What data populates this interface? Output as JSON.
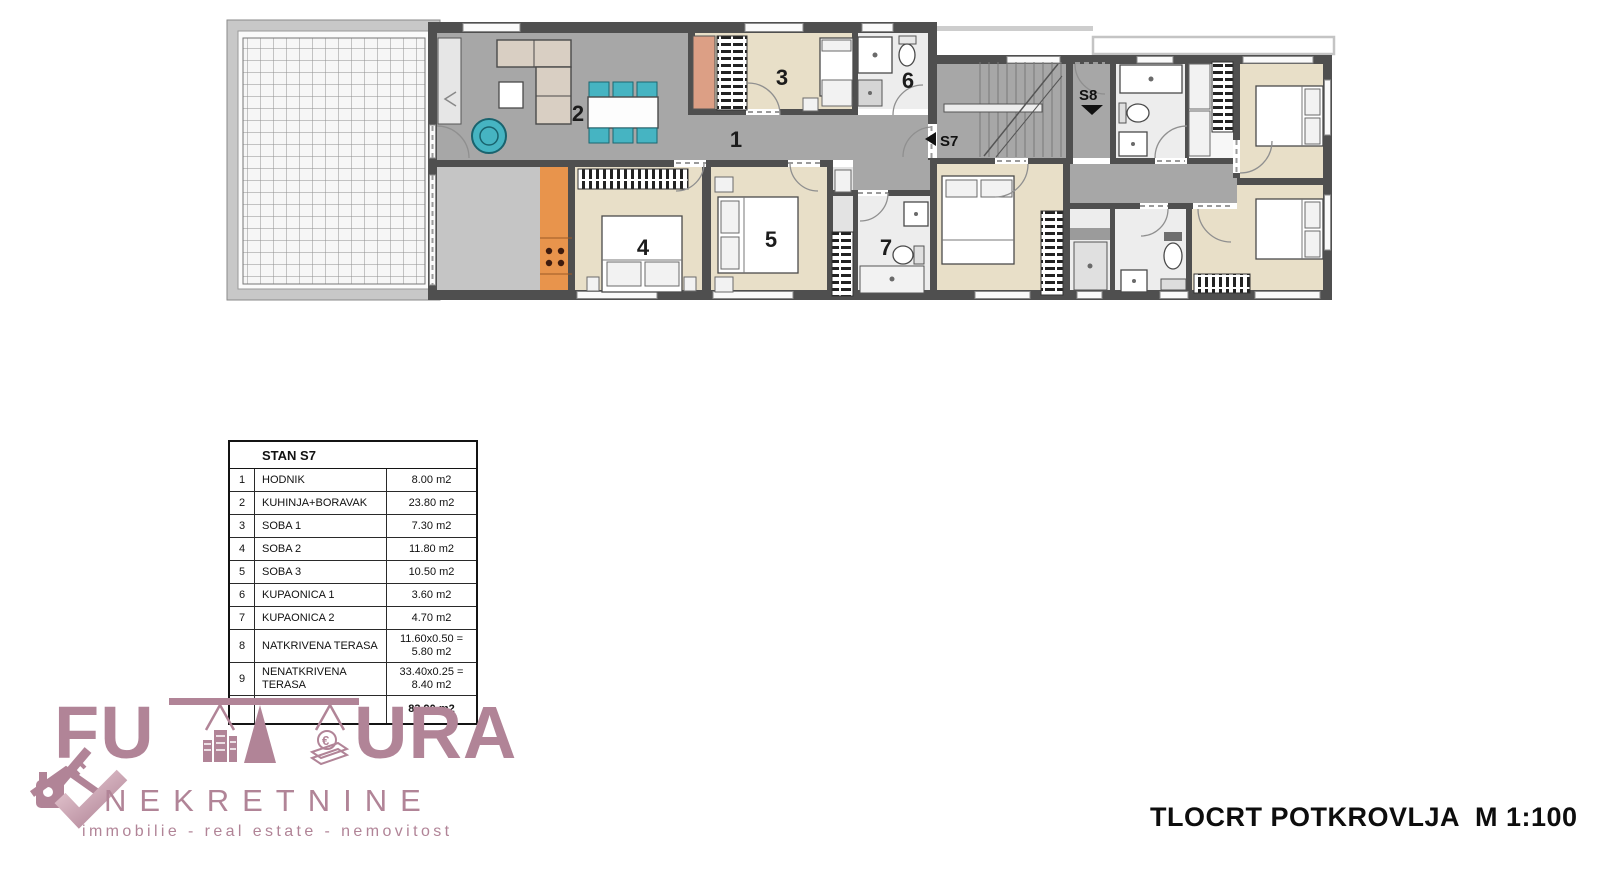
{
  "plan": {
    "room_labels": [
      "1",
      "2",
      "3",
      "4",
      "5",
      "6",
      "7"
    ],
    "markers": {
      "s7": "S7",
      "s8": "S8"
    },
    "colors": {
      "wall": "#4f4f4f",
      "corridor_floor": "#a7a7a7",
      "bedroom_floor": "#e8dfc8",
      "bathroom_floor": "#ededed",
      "storage_floor": "#c5c5c5",
      "kitchen_counter": "#e8944c",
      "closet": "#dc9f85",
      "furniture_teal": "#46b4c2",
      "sofa_beige": "#d9cfc3",
      "terrace_frame": "#c8c8c8"
    }
  },
  "area_table": {
    "header": "STAN S7",
    "rows": [
      {
        "num": "1",
        "name": "HODNIK",
        "value": "8.00 m2"
      },
      {
        "num": "2",
        "name": "KUHINJA+BORAVAK",
        "value": "23.80 m2"
      },
      {
        "num": "3",
        "name": "SOBA 1",
        "value": "7.30 m2"
      },
      {
        "num": "4",
        "name": "SOBA 2",
        "value": "11.80 m2"
      },
      {
        "num": "5",
        "name": "SOBA 3",
        "value": "10.50 m2"
      },
      {
        "num": "6",
        "name": "KUPAONICA 1",
        "value": "3.60 m2"
      },
      {
        "num": "7",
        "name": "KUPAONICA 2",
        "value": "4.70 m2"
      },
      {
        "num": "8",
        "name": "NATKRIVENA TERASA",
        "value": "11.60x0.50 = 5.80 m2"
      },
      {
        "num": "9",
        "name": "NENATKRIVENA TERASA",
        "value": "33.40x0.25 = 8.40 m2"
      }
    ],
    "total_value": "83.90 m2"
  },
  "logo": {
    "brand_full": "FUTURA",
    "brand_part1": "FU",
    "brand_part2": "URA",
    "subtitle": "NEKRETNINE",
    "tagline": "immobilie - real estate - nemovitost",
    "euro_symbol": "€",
    "color": "#b18497"
  },
  "title_block": {
    "text": "TLOCRT POTKROVLJA  M 1:100"
  }
}
